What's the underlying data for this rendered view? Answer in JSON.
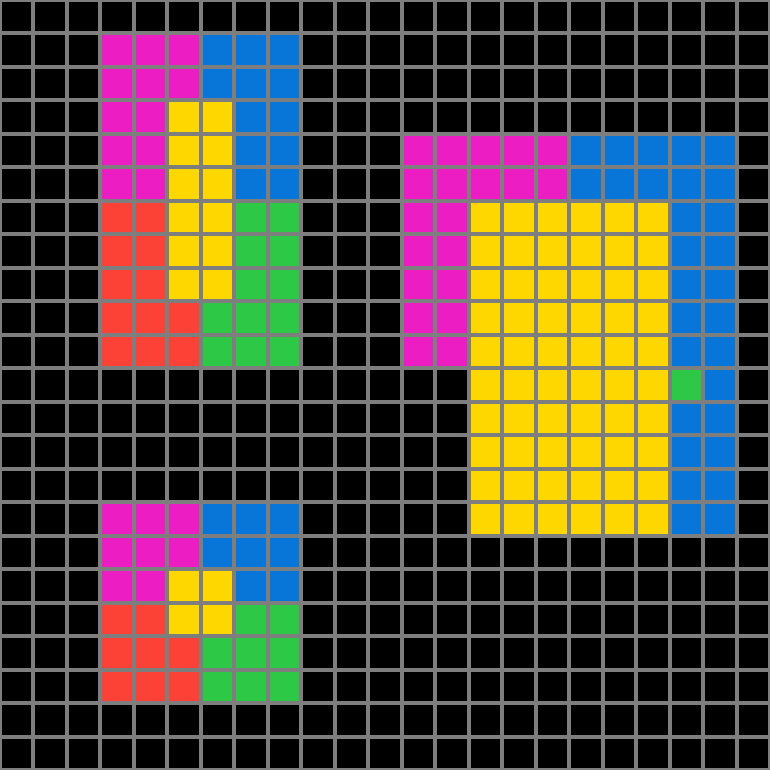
{
  "grid": {
    "rows": 23,
    "cols": 23,
    "cell_keys": {
      ".": "empty",
      "M": "magenta",
      "B": "blue",
      "Y": "yellow",
      "G": "green",
      "R": "red"
    },
    "palette": {
      "empty": "#000000",
      "magenta": "#EC1DC3",
      "blue": "#0876D8",
      "yellow": "#FED700",
      "green": "#2DC845",
      "red": "#FC4236",
      "gridline": "#7E7E7E"
    },
    "cells": [
      ".......................",
      "...MMMBBB..............",
      "...MMMBBB..............",
      "...MMYYBB..............",
      "...MMYYBB...MMMMMBBBBB.",
      "...MMYYBB...MMMMMBBBBB.",
      "...RRYYGG...MMYYYYYYBB.",
      "...RRYYGG...MMYYYYYYBB.",
      "...RRYYGG...MMYYYYYYBB.",
      "...RRRGGG...MMYYYYYYBB.",
      "...RRRGGG...MMYYYYYYBB.",
      "..............YYYYYYGB.",
      "..............YYYYYYBB.",
      "..............YYYYYYBB.",
      "..............YYYYYYBB.",
      "...MMMBBB.....YYYYYYBB.",
      "...MMMBBB..............",
      "...MMYYBB..............",
      "...RRYYGG..............",
      "...RRRGGG..............",
      "...RRRGGG..............",
      ".......................",
      "......................."
    ]
  }
}
